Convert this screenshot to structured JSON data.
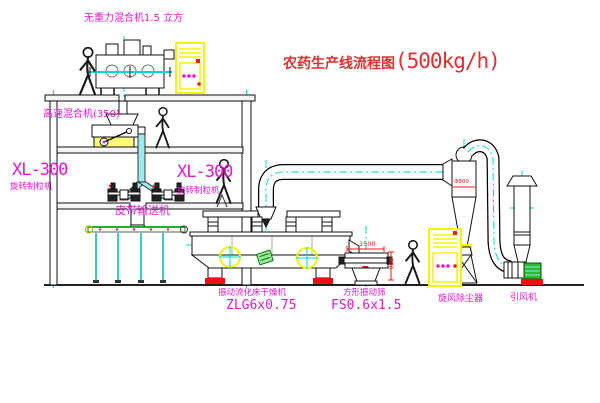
{
  "diagram": {
    "title_zh": "农药生产线流程图",
    "title_capacity": "(500kg/h)",
    "labels": {
      "gravity_mixer": "无重力混合机1.5 立方",
      "high_speed_mixer": "高速混合机(350)",
      "granulator_left_model": "XL-300",
      "granulator_left_name": "旋转制粒机",
      "granulator_right_model": "XL-300",
      "granulator_right_name": "旋转制粒机",
      "belt_conveyor": "皮带输送机",
      "dryer_name": "振动流化床干燥机",
      "dryer_model": "ZLG6x0.75",
      "screen_name": "方形振动筛",
      "screen_model": "FS0.6x1.5",
      "cyclone": "旋风除尘器",
      "fan": "引风机"
    },
    "dimensions": {
      "screen_length": "1500",
      "screen_width": "600",
      "cyclone_dia": "Φ800"
    },
    "colors": {
      "line": "#000000",
      "centerline": "#00d8d8",
      "pipe_fill": "#9fe8ec",
      "label_magenta": "#e617d4",
      "title_red": "#e03030",
      "dimension_red": "#ff1414",
      "highlight_yellow": "#f5f500",
      "status_green": "#2eb82e"
    }
  }
}
